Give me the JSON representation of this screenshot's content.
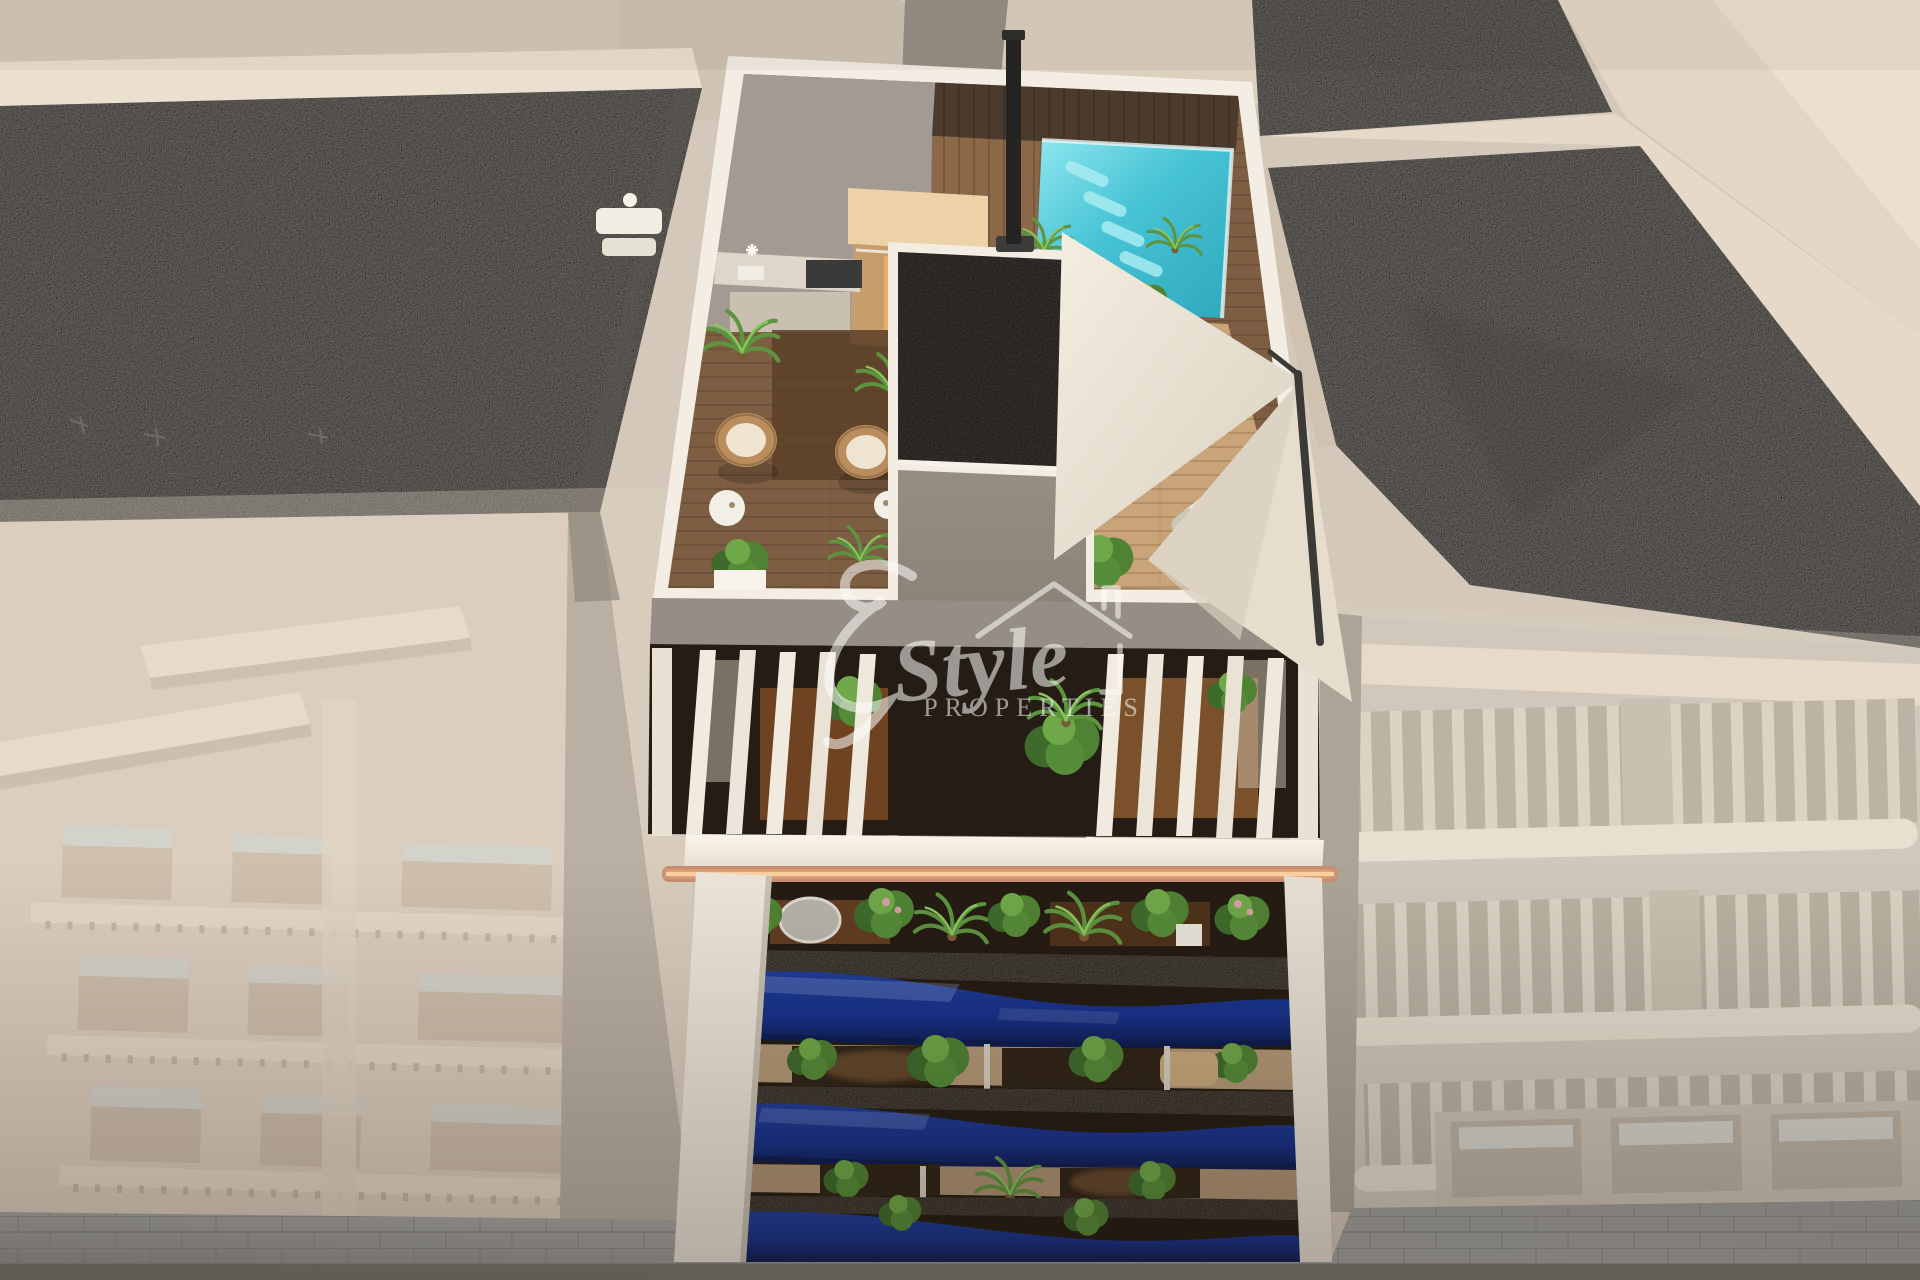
{
  "scene": {
    "type": "3D architectural render, aerial view",
    "subject": "Modern apartment tower with rooftop pool terrace, louvered penthouse level and wavy blue glass balconies, flanked by faded neighbouring buildings above a paved street"
  },
  "watermark": {
    "initial_flourish": "E",
    "name_script": "Style",
    "name_caps": "PROPERTIES"
  },
  "palette": {
    "backdrop": "#d3c8b9",
    "roof_gravel": "#8f8b85",
    "core_gravel": "#4e4a45",
    "parapet_white": "#f3ede3",
    "deck_wood": "#7e5e42",
    "dark_walkway": "#4c3b2d",
    "pool_light": "#6fdbe8",
    "pool_deep": "#2fa8bd",
    "sauna_wood": "#c59e6b",
    "sun_deck": "#c9a478",
    "sail": "#efe7d8",
    "balcony_blue": "#16308a",
    "balcony_blue_deep": "#0c1c52",
    "balcony_cap": "#6b6257",
    "led_copper": "#c98d6f",
    "plant_green": "#4f8233",
    "street_paver": "#a3a3a1",
    "street_dark": "#75746e",
    "faded_left_building": "#d8cbbc",
    "faded_right_building": "#cdc4b8"
  }
}
